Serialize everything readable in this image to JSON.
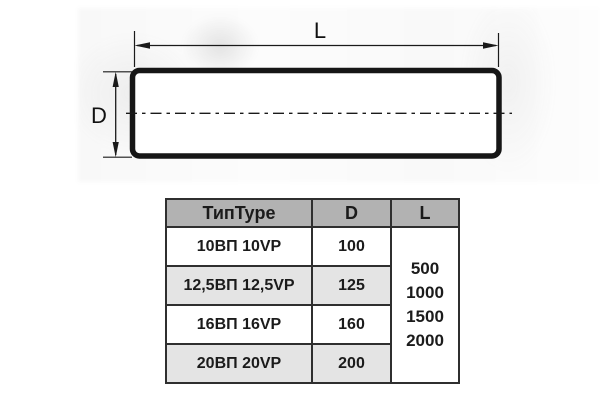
{
  "diagram": {
    "length_label": "L",
    "diameter_label": "D"
  },
  "table": {
    "columns": {
      "type": "ТипType",
      "d": "D",
      "l": "L"
    },
    "rows": [
      {
        "type": "10ВП 10VP",
        "d": "100"
      },
      {
        "type": "12,5ВП 12,5VP",
        "d": "125"
      },
      {
        "type": "16ВП 16VP",
        "d": "160"
      },
      {
        "type": "20ВП 20VP",
        "d": "200"
      }
    ],
    "l_values": [
      "500",
      "1000",
      "1500",
      "2000"
    ]
  },
  "colors": {
    "header_bg": "#b2b2b2",
    "row_alt_bg": "#e4e4e4",
    "table_border": "#2f2f2f",
    "drawing_line": "#161616",
    "background": "#ffffff"
  }
}
